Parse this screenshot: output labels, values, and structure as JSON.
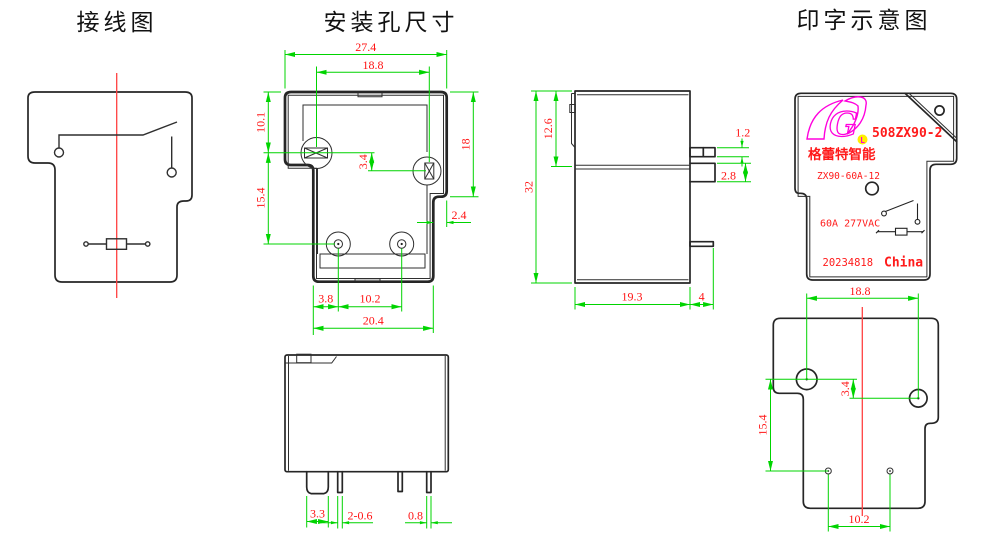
{
  "titles": {
    "wiring": "接线图",
    "mounting": "安装孔尺寸",
    "marking": "印字示意图"
  },
  "mounting_view": {
    "dims": {
      "overall_width": "27.4",
      "slot_spacing": "18.8",
      "top_to_slot": "10.1",
      "slot_offset": "3.4",
      "flange_height": "18",
      "slot_to_hole": "15.4",
      "step_width": "2.4",
      "edge_to_hole": "3.8",
      "hole_spacing": "10.2",
      "body_width": "20.4"
    }
  },
  "front_view": {
    "dims": {
      "qc_pin_width": "3.3",
      "coil_pin_width": "2-0.6",
      "pin_width": "0.8"
    }
  },
  "side_view": {
    "dims": {
      "overall_height": "32",
      "flange_offset": "12.6",
      "tab_thickness": "1.2",
      "flange_thickness": "2.8",
      "body_depth": "19.3",
      "tab_overhang": "4"
    }
  },
  "marking_view": {
    "model": "508ZX90-2",
    "logo_letter": "L",
    "brand": "格蕾特智能",
    "type_code": "ZX90-60A-12",
    "rating": "60A 277VAC",
    "date_code": "20234818",
    "origin": "China"
  },
  "bottom_view": {
    "dims": {
      "hole_spacing": "18.8",
      "hole_offset": "3.4",
      "hole_to_pinhole": "15.4",
      "pinhole_spacing": "10.2"
    }
  },
  "colors": {
    "dimension_line": "#00d400",
    "dimension_text": "#ff1414",
    "centerline": "#ff4040",
    "outline": "#262626",
    "logo_magenta": "#ff00dd",
    "logo_yellow": "#ffee00",
    "print_red": "#ff1a1a",
    "background": "#ffffff"
  }
}
